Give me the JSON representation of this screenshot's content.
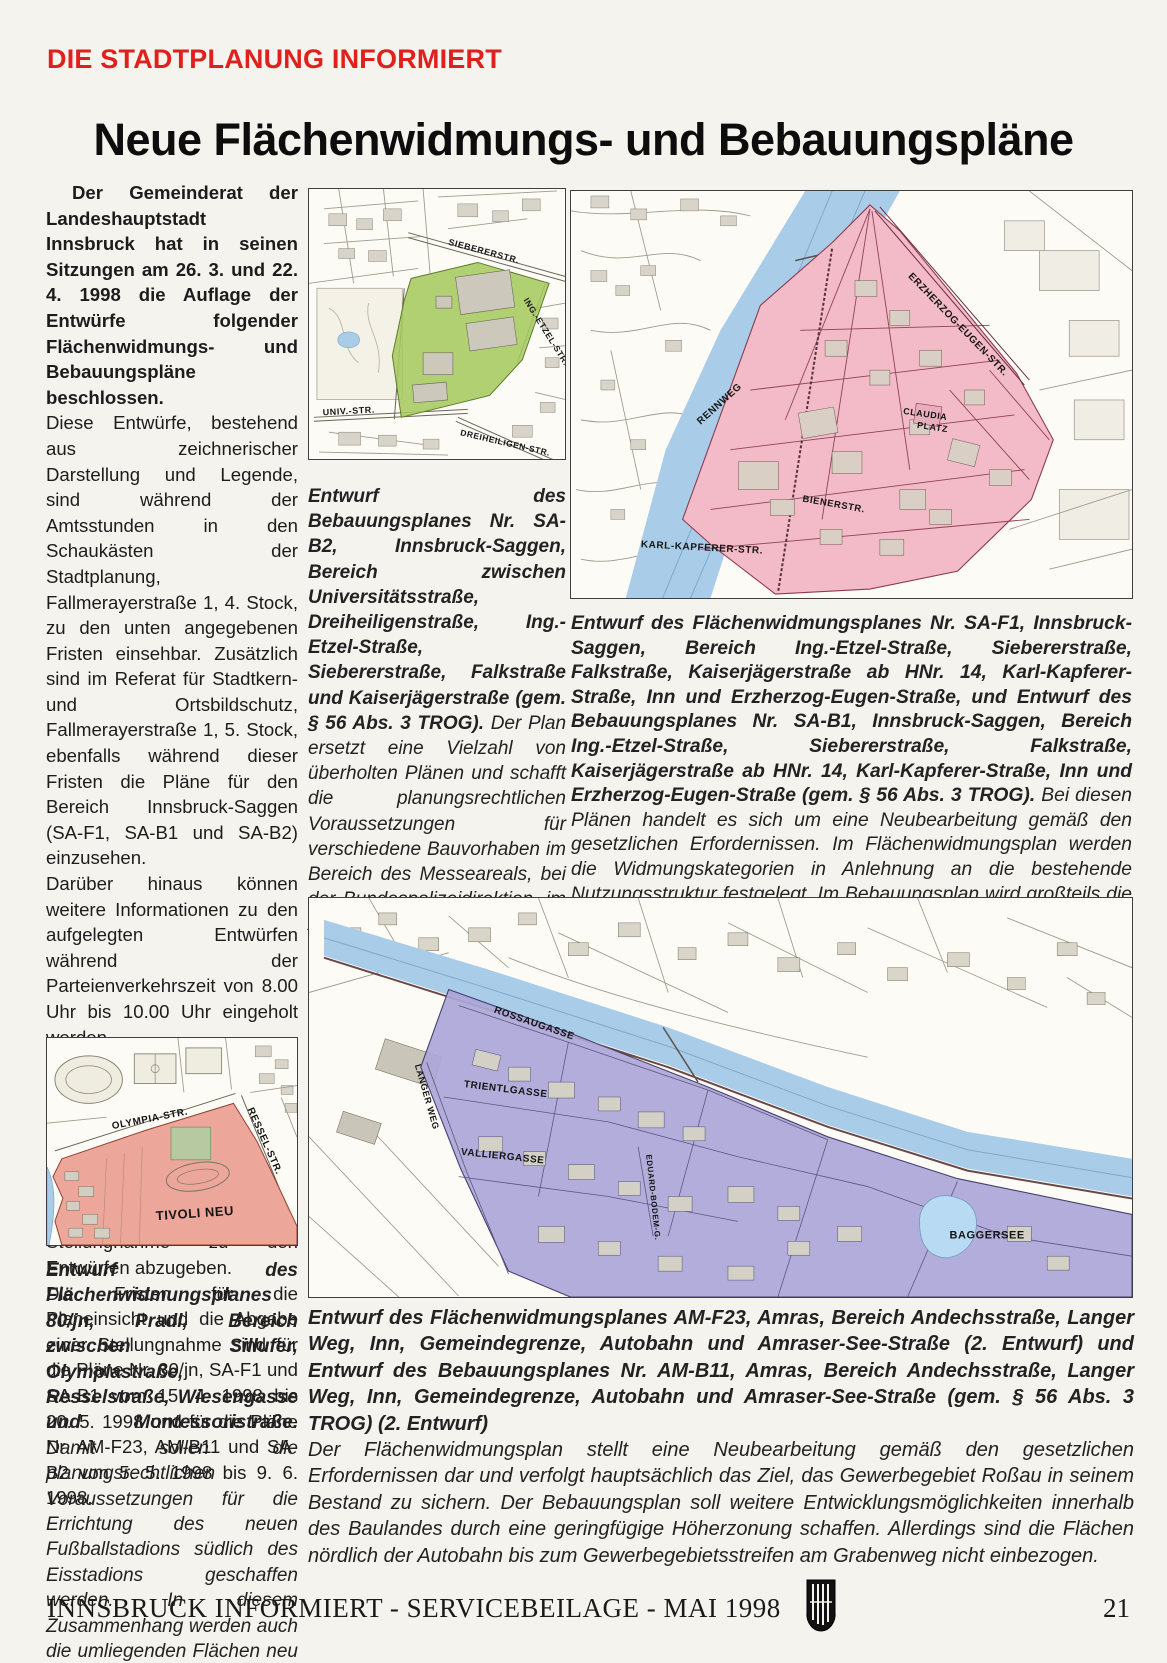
{
  "page": {
    "kicker": "DIE STADTPLANUNG INFORMIERT",
    "title": "Neue Flächenwidmungs- und Bebauungspläne",
    "footer_text": "INNSBRUCK INFORMIERT - SERVICEBEILAGE - MAI 1998",
    "page_number": "21"
  },
  "article": {
    "lead": "Der Gemeinderat der Landeshauptstadt Innsbruck hat in seinen Sitzungen am 26. 3. und 22. 4. 1998 die Auflage der Entwürfe folgender Flächenwidmungs- und Bebauungspläne beschlossen.",
    "paragraphs": [
      "Diese Entwürfe, bestehend aus zeichnerischer Darstellung und Legende, sind während der Amtsstunden in den Schaukästen der Stadtplanung, Fallmerayerstraße 1, 4. Stock, zu den unten angegebenen Fristen einsehbar. Zusätzlich sind im Referat für Stadtkern- und Ortsbildschutz, Fallmerayerstraße 1, 5. Stock, ebenfalls während dieser Fristen die Pläne für den Bereich Innsbruck-Saggen (SA-F1, SA-B1 und SA-B2) einzusehen.",
      "Darüber hinaus können weitere Informationen zu den aufgelegten Entwürfen während der Parteienverkehrszeit von 8.00 Uhr bis 10.00 Uhr eingeholt werden.",
      "Personen, die in der Gemeinde einen Wohnsitz haben, und Rechtsträger, die in der Gemeinde eine Liegenschaft oder einen Betrieb besitzen, haben das Recht, eine schriftliche Stellungnahme zu den Entwürfen abzugeben.",
      "Die Fristen für die Planeinsicht und die Abgabe einer Stellungnahme sind für die Pläne Nr. 80/jn, SA-F1 und SA-B1 vom 15. 4. 1998 bis 20. 5. 1998 und für die Pläne Nr. AM-F23, AM-B11 und SA-B2 von 5. 5. 1998 bis 9. 6. 1998."
    ]
  },
  "captions": {
    "sa_b2": {
      "head": "Entwurf des Bebauungsplanes Nr. SA-B2, Innsbruck-Saggen, Bereich zwischen Universitätsstraße, Dreiheiligenstraße, Ing.-Etzel-Straße, Siebererstraße, Falkstraße und Kaiserjägerstraße (gem. § 56 Abs. 3 TROG).",
      "body": "Der Plan ersetzt eine Vielzahl von überholten Plänen und schafft die planungsrechtlichen Voraussetzungen für verschiedene Bauvorhaben im Bereich des Messeareals, bei der Bundespolizeidirektion, im Areal des Kapuzinerklosters sowie im Bereich des Hotels Schwarzer Adler. Im übrigen wird die vorhandene Baustruktur in Anlehnung an den Bestand festgelegt."
    },
    "sa_f1": {
      "head": "Entwurf des Flächenwidmungsplanes Nr. SA-F1, Innsbruck-Saggen, Bereich Ing.-Etzel-Straße, Siebererstraße, Falkstraße, Kaiserjägerstraße ab HNr. 14, Karl-Kapferer-Straße, Inn und Erzherzog-Eugen-Straße, und Entwurf des Bebauungsplanes Nr. SA-B1, Innsbruck-Saggen, Bereich Ing.-Etzel-Straße, Siebererstraße, Falkstraße, Kaiserjägerstraße ab HNr. 14, Karl-Kapferer-Straße, Inn und Erzherzog-Eugen-Straße (gem. § 56 Abs. 3 TROG).",
      "body": "Bei diesen Plänen handelt es sich um eine Neubearbeitung gemäß den gesetzlichen Erfordernissen. Im Flächenwidmungsplan werden die Widmungskategorien in Anlehnung an die bestehende Nutzungsstruktur festgelegt. Im Bebauungsplan wird großteils die bestehende Baustruktur durch entsprechende Bestimmungen gesichert."
    },
    "tivoli": {
      "head": "Entwurf des Flächenwidmungsplanes 80/jn, Pradl, Bereich zwischen Sillufer, Olympiastraße, Resselstraße, Wiesengasse und Montessoristraße.",
      "body": "Damit sollen die planungsrechtlichen Voraussetzungen für die Errichtung des neuen Fußballstadions südlich des Eisstadions geschaffen werden. In diesem Zusammenhang werden auch die umliegenden Flächen neu festgelegt."
    },
    "am_f23": {
      "head": "Entwurf des Flächenwidmungsplanes AM-F23, Amras, Bereich Andechsstraße, Langer Weg, Inn, Gemeindegrenze, Autobahn und Amraser-See-Straße (2. Entwurf) und Entwurf des Bebauungsplanes Nr. AM-B11, Amras, Bereich Andechsstraße, Langer Weg, Inn, Gemeindegrenze, Autobahn und Amraser-See-Straße (gem. § 56 Abs. 3 TROG) (2. Entwurf)",
      "body": "Der Flächenwidmungsplan stellt eine Neubearbeitung gemäß den gesetzlichen Erfordernissen dar und verfolgt hauptsächlich das Ziel, das Gewerbegebiet Roßau in seinem Bestand zu sichern. Der Bebauungsplan soll weitere Entwicklungsmöglichkeiten innerhalb des Baulandes durch eine geringfügige Höherzonung schaffen. Allerdings sind die Flächen nördlich der Autobahn bis zum Gewerbegebietsstreifen am Grabenweg nicht einbezogen."
    }
  },
  "maps": {
    "saggen_b2": {
      "labels": {
        "sieberer": "SIEBERERSTR.",
        "etzel": "ING.-ETZEL-STR.",
        "univ": "UNIV.-STR.",
        "dreiheiligen": "DREIHEILIGEN-STR."
      }
    },
    "saggen_f1": {
      "labels": {
        "erzherzog": "ERZHERZOG-EUGEN-STR.",
        "rennweg": "RENNWEG",
        "claudia_line1": "CLAUDIA",
        "claudia_line2": "PLATZ",
        "biener": "BIENERSTR.",
        "kapferer": "KARL-KAPFERER-STR."
      }
    },
    "amras": {
      "labels": {
        "rossau": "ROSSAUGASSE",
        "trientl": "TRIENTLGASSE",
        "vallier": "VALLIERGASSE",
        "langer_weg": "LANGER WEG",
        "bodem": "EDUARD-BODEM-G.",
        "baggersee": "BAGGERSEE"
      }
    },
    "tivoli": {
      "labels": {
        "olympia": "OLYMPIA-STR.",
        "ressel": "RESSEL-STR.",
        "tivoli_neu": "TIVOLI NEU"
      }
    }
  },
  "colors": {
    "kicker_red": "#e0201c",
    "zone_green": "#a6c95e",
    "zone_pink": "#f3bac7",
    "zone_purple": "#aba6d7",
    "zone_salmon": "#eba092",
    "water_blue": "#a9cde8"
  }
}
